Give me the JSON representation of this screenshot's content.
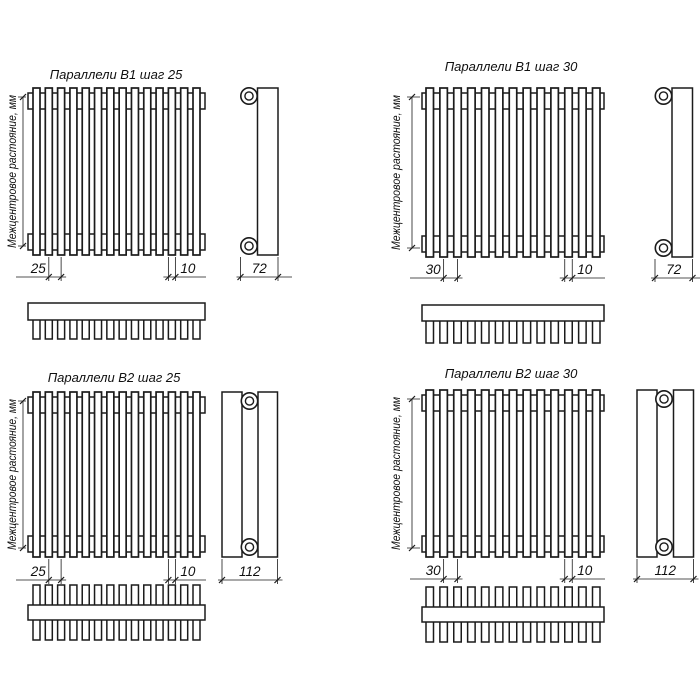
{
  "drawing": {
    "colors": {
      "line": "#1b1b1b",
      "paper": "#ffffff"
    },
    "vertical_axis_label": "Межцентровое растояние, мм",
    "panels": [
      {
        "id": "b1-step-25",
        "title": "Параллели В1 шаг 25",
        "step_label": "25",
        "tube_width_label": "10",
        "depth_label": "72",
        "tube_count": 14,
        "tube_rows": 1
      },
      {
        "id": "b1-step-30",
        "title": "Параллели В1 шаг 30",
        "step_label": "30",
        "tube_width_label": "10",
        "depth_label": "72",
        "tube_count": 13,
        "tube_rows": 1
      },
      {
        "id": "b2-step-25",
        "title": "Параллели В2 шаг 25",
        "step_label": "25",
        "tube_width_label": "10",
        "depth_label": "112",
        "tube_count": 14,
        "tube_rows": 2
      },
      {
        "id": "b2-step-30",
        "title": "Параллели В2 шаг 30",
        "step_label": "30",
        "tube_width_label": "10",
        "depth_label": "112",
        "tube_count": 13,
        "tube_rows": 2
      }
    ]
  }
}
